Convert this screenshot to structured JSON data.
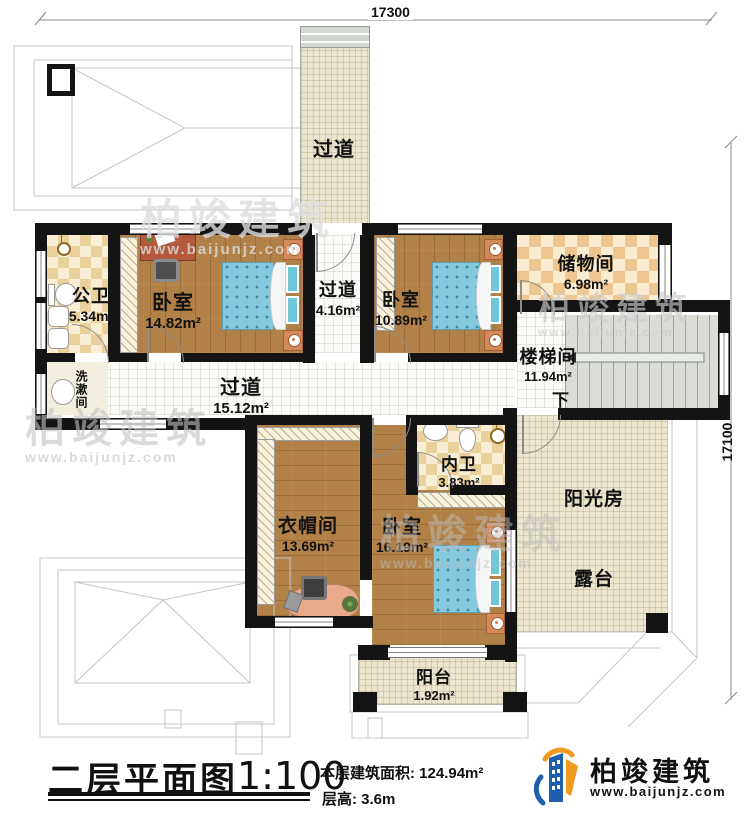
{
  "dimensions": {
    "top": "17300",
    "right": "17100"
  },
  "rooms": {
    "corridor_top": {
      "name": "过道"
    },
    "gongwei": {
      "name": "公卫",
      "area": "5.34m²"
    },
    "bedroom1": {
      "name": "卧室",
      "area": "14.82m²"
    },
    "corridor_mid": {
      "name": "过道",
      "area": "4.16m²"
    },
    "bedroom2": {
      "name": "卧室",
      "area": "10.89m²"
    },
    "storage": {
      "name": "储物间",
      "area": "6.98m²"
    },
    "stairwell": {
      "name": "楼梯间",
      "area": "11.94m²",
      "down": "下"
    },
    "washroom": {
      "name": "洗漱间"
    },
    "corridor_main": {
      "name": "过道",
      "area": "15.12m²"
    },
    "cloakroom": {
      "name": "衣帽间",
      "area": "13.69m²"
    },
    "bedroom3": {
      "name": "卧室",
      "area": "16.19m²"
    },
    "neiwei": {
      "name": "内卫",
      "area": "3.83m²"
    },
    "sunroom": {
      "name": "阳光房"
    },
    "terrace": {
      "name": "露台"
    },
    "balcony": {
      "name": "阳台",
      "area": "1.92m²"
    }
  },
  "title": {
    "text": "二层平面图",
    "scale": "1:100",
    "area_label": "本层建筑面积: 124.94m²",
    "height_label": "层高: 3.6m"
  },
  "logo": {
    "name": "柏竣建筑",
    "url": "www.baijunjz.com"
  },
  "watermark": {
    "text": "柏竣建筑",
    "url": "www.baijunjz.com"
  },
  "colors": {
    "wall": "#141414",
    "wood_floor": "#b28147",
    "checker_tan": "#ead09b",
    "bed_blue": "#84c9dd",
    "logo_blue": "#1f5fae",
    "logo_orange": "#f29a20"
  }
}
